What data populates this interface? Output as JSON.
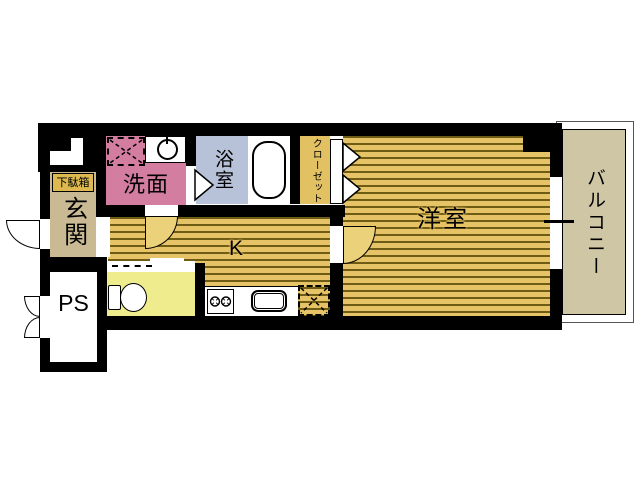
{
  "floorplan": {
    "title": "1K apartment floor plan",
    "rooms": {
      "entrance": {
        "label": "玄関"
      },
      "shoe_cabinet": {
        "label": "下駄箱"
      },
      "washroom": {
        "label": "洗面"
      },
      "bathroom": {
        "label": "浴室"
      },
      "closet": {
        "label": "クローゼット"
      },
      "kitchen": {
        "label": "K"
      },
      "western_room": {
        "label": "洋室"
      },
      "balcony": {
        "label": "バルコニー"
      },
      "pipe_space": {
        "label": "PS"
      }
    },
    "colors": {
      "wall": "#000000",
      "entrance": "#c9ba93",
      "shoe_cabinet": "#ddb94f",
      "washroom": "#d37da0",
      "bathroom": "#b7c1d8",
      "toilet_room": "#eeec8d",
      "flooring": "#e6c366",
      "flooring_stripe": "#6e5c14",
      "closet": "#e2c162",
      "door_leaf": "#ecd17b",
      "balcony": "#cfc6a5"
    }
  }
}
